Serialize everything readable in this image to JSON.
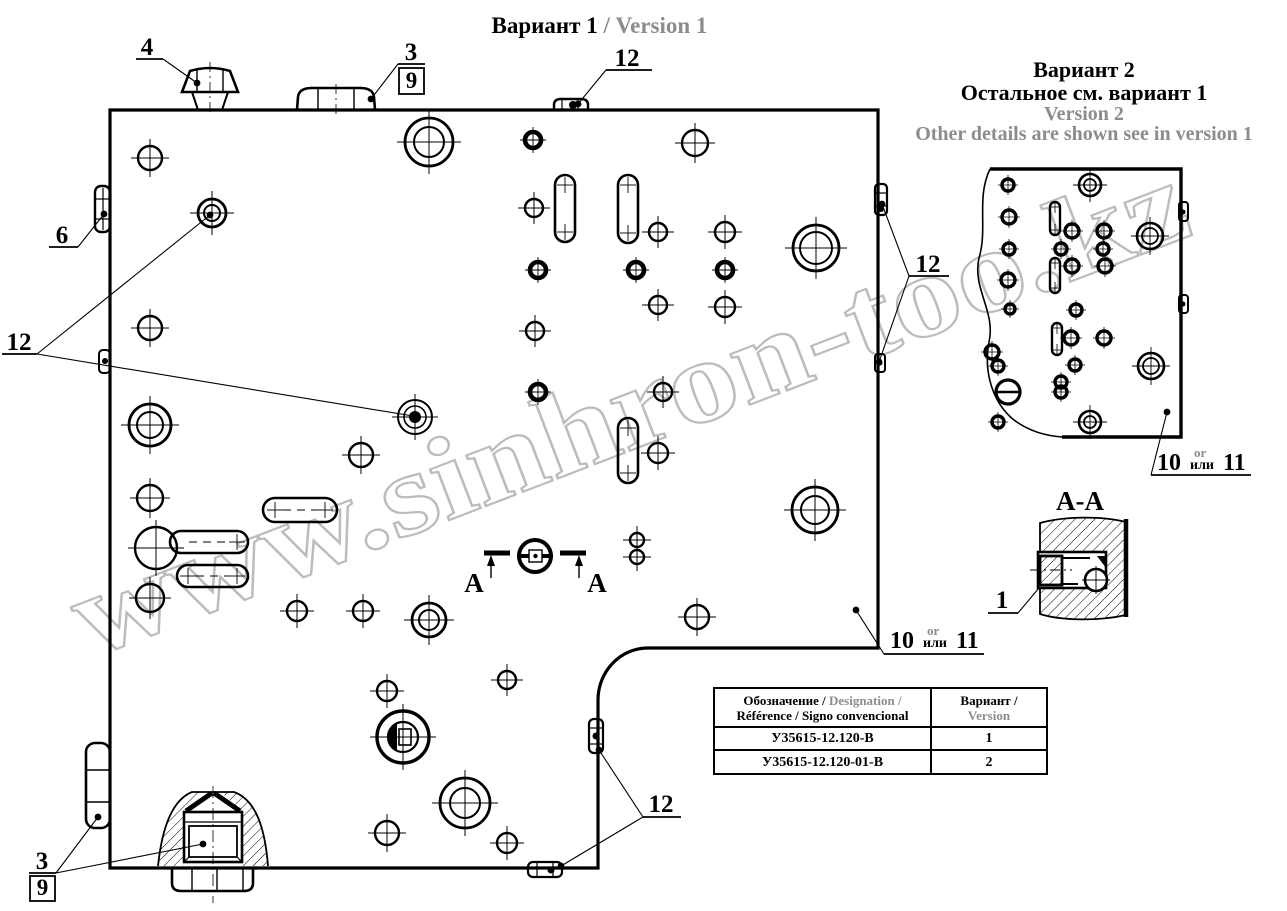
{
  "watermark": {
    "text": "www.sinhron-too.kz",
    "color": "#bcbcbc"
  },
  "titles": {
    "v1_ru": "Вариант 1",
    "v1_en": " / Version 1",
    "v2_ru1": "Вариант 2",
    "v2_ru2": "Остальное см. вариант 1",
    "v2_en1": "Version 2",
    "v2_en2": "Other details are shown see in version 1"
  },
  "section_view": {
    "title": "А-А"
  },
  "section_marker": {
    "left": "А",
    "right": "А"
  },
  "table": {
    "header": {
      "col1_black1": "Обозначение / ",
      "col1_gray": "Designation /",
      "col1_black2": "Référence / Signo convencional",
      "col2_black": "Вариант /",
      "col2_gray": "Version"
    },
    "rows": [
      {
        "designation": "У35615-12.120-В",
        "variant": "1"
      },
      {
        "designation": "У35615-12.120-01-В",
        "variant": "2"
      }
    ]
  },
  "callouts": [
    {
      "type": "plain",
      "text": "4",
      "tx": 147,
      "ty": 55,
      "ul": [
        136,
        163,
        59
      ],
      "from": [
        163,
        59
      ],
      "targets": [
        {
          "p": [
            197,
            83
          ],
          "dot": true
        }
      ]
    },
    {
      "type": "boxed",
      "text": "3",
      "boxText": "9",
      "tx": 411,
      "ty": 60,
      "ul": [
        398,
        425,
        64
      ],
      "box": [
        399,
        68,
        25,
        26
      ],
      "from": [
        398,
        64
      ],
      "targets": [
        {
          "p": [
            371,
            99
          ],
          "dot": true
        }
      ]
    },
    {
      "type": "plain",
      "text": "12",
      "tx": 627,
      "ty": 66,
      "ul": [
        606,
        652,
        70
      ],
      "from": [
        606,
        70
      ],
      "targets": [
        {
          "p": [
            578,
            104
          ],
          "dot": true
        }
      ]
    },
    {
      "type": "plain",
      "text": "6",
      "tx": 62,
      "ty": 243,
      "ul": [
        49,
        78,
        247
      ],
      "from": [
        78,
        247
      ],
      "targets": [
        {
          "p": [
            104,
            214
          ],
          "dot": true
        }
      ]
    },
    {
      "type": "plain",
      "text": "12",
      "tx": 19,
      "ty": 350,
      "ul": [
        2,
        37,
        354
      ],
      "from": [
        37,
        354
      ],
      "targets": [
        {
          "p": [
            210,
            215
          ],
          "dot": true
        },
        {
          "p": [
            413,
            416
          ],
          "dot": true
        }
      ]
    },
    {
      "type": "plain",
      "text": "12",
      "tx": 928,
      "ty": 272,
      "ul": [
        909,
        949,
        276
      ],
      "from": [
        909,
        276
      ],
      "targets": [
        {
          "p": [
            882,
            204
          ],
          "dot": true
        },
        {
          "p": [
            879,
            362
          ],
          "dot": true
        }
      ]
    },
    {
      "type": "alt",
      "big1": "10",
      "small_top": "or",
      "small_bot": "или",
      "big2": "11",
      "x": 890,
      "y": 648,
      "ul": [
        884,
        984,
        654
      ],
      "from": [
        884,
        654
      ],
      "targets": [
        {
          "p": [
            856,
            610
          ],
          "dot": true
        }
      ]
    },
    {
      "type": "alt",
      "big1": "10",
      "small_top": "or",
      "small_bot": "или",
      "big2": "11",
      "x": 1157,
      "y": 470,
      "ul": [
        1151,
        1251,
        475
      ],
      "from": [
        1151,
        475
      ],
      "targets": [
        {
          "p": [
            1167,
            412
          ],
          "dot": true
        }
      ]
    },
    {
      "type": "plain",
      "text": "1",
      "tx": 1002,
      "ty": 608,
      "ul": [
        988,
        1018,
        613
      ],
      "from": [
        1018,
        613
      ],
      "targets": [
        {
          "p": [
            1039,
            588
          ],
          "dot": false
        }
      ]
    },
    {
      "type": "boxed",
      "text": "3",
      "boxText": "9",
      "tx": 42,
      "ty": 869,
      "ul": [
        29,
        56,
        873
      ],
      "box": [
        30,
        876,
        25,
        25
      ],
      "from": [
        56,
        873
      ],
      "targets": [
        {
          "p": [
            98,
            817
          ],
          "dot": true
        },
        {
          "p": [
            203,
            844
          ],
          "dot": true
        }
      ]
    },
    {
      "type": "plain",
      "text": "12",
      "tx": 661,
      "ty": 812,
      "ul": [
        643,
        681,
        817
      ],
      "from": [
        643,
        817
      ],
      "targets": [
        {
          "p": [
            599,
            750
          ],
          "dot": true
        },
        {
          "p": [
            561,
            866
          ],
          "dot": true
        }
      ]
    }
  ],
  "drawing": {
    "main": {
      "holes_thin": [
        [
          150,
          158,
          12
        ],
        [
          695,
          143,
          13
        ],
        [
          150,
          328,
          12
        ],
        [
          534,
          208,
          9
        ],
        [
          658,
          232,
          9
        ],
        [
          725,
          232,
          10
        ],
        [
          658,
          305,
          9
        ],
        [
          725,
          307,
          10
        ],
        [
          535,
          331,
          9
        ],
        [
          663,
          392,
          9
        ],
        [
          361,
          455,
          12
        ],
        [
          658,
          453,
          10
        ],
        [
          150,
          498,
          13
        ],
        [
          156,
          548,
          21
        ],
        [
          150,
          598,
          14
        ],
        [
          297,
          611,
          10
        ],
        [
          363,
          611,
          10
        ],
        [
          697,
          617,
          12
        ],
        [
          637,
          540,
          7
        ],
        [
          637,
          557,
          7
        ],
        [
          387,
          691,
          10
        ],
        [
          507,
          680,
          9
        ],
        [
          387,
          833,
          12
        ],
        [
          507,
          843,
          10
        ]
      ],
      "holes_bold": [
        [
          533,
          140,
          8
        ],
        [
          538,
          270,
          8
        ],
        [
          636,
          270,
          8
        ],
        [
          725,
          270,
          8
        ],
        [
          538,
          392,
          8
        ]
      ],
      "holes_double": [
        [
          429,
          142,
          24,
          15
        ],
        [
          816,
          248,
          23,
          16
        ],
        [
          212,
          213,
          14,
          8
        ],
        [
          150,
          425,
          21,
          13
        ],
        [
          815,
          510,
          23,
          14
        ],
        [
          429,
          620,
          17,
          10
        ],
        [
          465,
          803,
          25,
          15
        ]
      ],
      "slots_v": [
        [
          565,
          175,
          242,
          10
        ],
        [
          628,
          175,
          243,
          10
        ],
        [
          628,
          418,
          483,
          10
        ]
      ],
      "slots_h": [
        [
          510,
          263,
          337,
          12,
          1,
          1,
          1
        ],
        [
          576,
          177,
          248,
          11,
          1,
          1,
          1
        ],
        [
          542,
          170,
          248,
          11,
          1,
          0,
          1
        ]
      ]
    },
    "fragment": {
      "holes_bold": [
        [
          1008,
          185,
          6
        ],
        [
          1009,
          217,
          7
        ],
        [
          1072,
          231,
          7
        ],
        [
          1104,
          231,
          7
        ],
        [
          1009,
          249,
          6
        ],
        [
          1061,
          249,
          6
        ],
        [
          1103,
          249,
          6
        ],
        [
          1008,
          280,
          7
        ],
        [
          1072,
          266,
          7
        ],
        [
          1105,
          266,
          7
        ],
        [
          1010,
          309,
          5
        ],
        [
          1076,
          310,
          6
        ],
        [
          1071,
          338,
          7
        ],
        [
          1104,
          338,
          7
        ],
        [
          992,
          352,
          7
        ],
        [
          998,
          366,
          6
        ],
        [
          1075,
          365,
          6
        ],
        [
          1061,
          382,
          6
        ],
        [
          1061,
          392,
          6
        ],
        [
          998,
          422,
          6
        ]
      ],
      "holes_double": [
        [
          1090,
          185,
          11,
          6
        ],
        [
          1150,
          236,
          13,
          8
        ],
        [
          1151,
          366,
          13,
          8
        ],
        [
          1090,
          422,
          11,
          6
        ]
      ],
      "slots_v": [
        [
          1055,
          202,
          235,
          5
        ],
        [
          1055,
          258,
          293,
          5
        ],
        [
          1057,
          323,
          355,
          5
        ]
      ]
    }
  }
}
